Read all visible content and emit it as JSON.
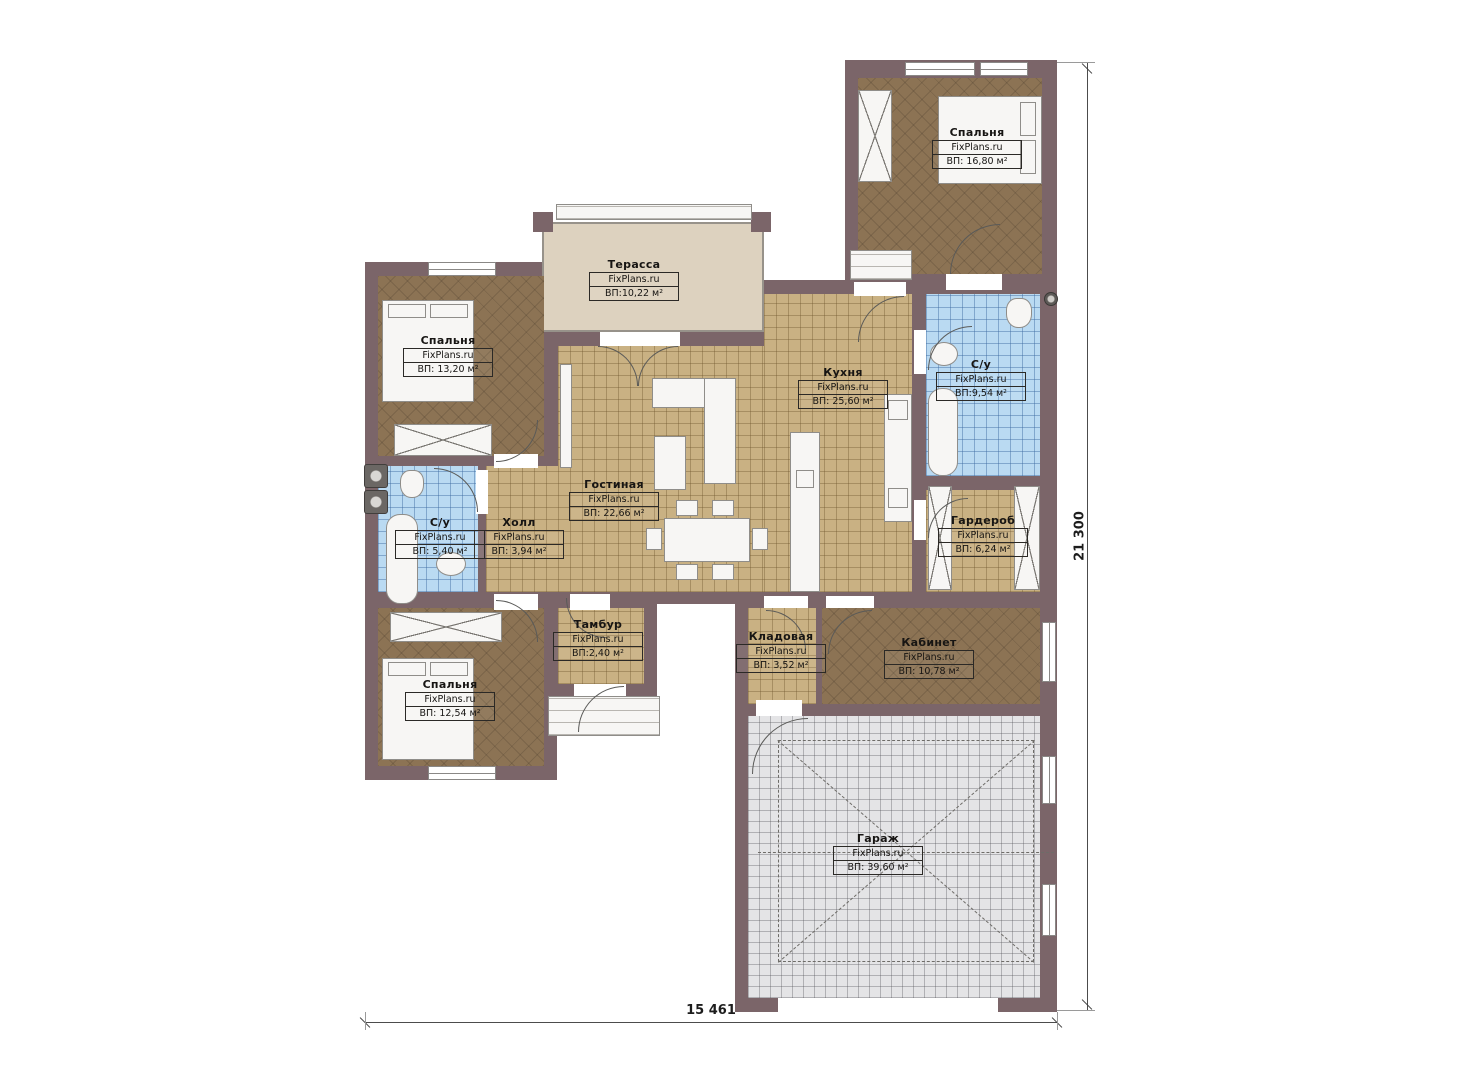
{
  "brand_label": "FixPlans.ru",
  "dimensions": {
    "bottom": "15 461",
    "right": "21 300"
  },
  "colors": {
    "wall": "#7b6569",
    "wood_floor": "#8c7354",
    "tile_floor": "#c9b183",
    "bath_floor": "#badaf2",
    "garage_floor": "#e4e4e6",
    "terrace_floor": "#ddd2bf",
    "furniture": "#f7f6f4"
  },
  "rooms": [
    {
      "id": "bedroom-top-right",
      "name": "Спальня",
      "area": "ВП: 16,80 м²",
      "floor": "wood",
      "rect": [
        858,
        78,
        184,
        196
      ],
      "label": [
        977,
        126
      ]
    },
    {
      "id": "terrace",
      "name": "Терасса",
      "area": "ВП:10,22 м²",
      "floor": "terrace",
      "rect": [
        542,
        222,
        222,
        110
      ],
      "label": [
        634,
        258
      ]
    },
    {
      "id": "bedroom-left-top",
      "name": "Спальня",
      "area": "ВП: 13,20 м²",
      "floor": "wood",
      "rect": [
        378,
        276,
        166,
        180
      ],
      "label": [
        448,
        334
      ]
    },
    {
      "id": "kitchen",
      "name": "Кухня",
      "area": "ВП: 25,60 м²",
      "floor": "tile",
      "rect": [
        764,
        294,
        148,
        298
      ],
      "label": [
        843,
        366
      ]
    },
    {
      "id": "bathroom-top",
      "name": "С/у",
      "area": "ВП:9,54 м²",
      "floor": "bath",
      "rect": [
        926,
        294,
        114,
        182
      ],
      "label": [
        981,
        358
      ]
    },
    {
      "id": "living-room",
      "name": "Гостиная",
      "area": "ВП: 22,66 м²",
      "floor": "tile",
      "rect": [
        558,
        346,
        206,
        246
      ],
      "label": [
        614,
        478
      ]
    },
    {
      "id": "hall",
      "name": "Холл",
      "area": "ВП: 3,94 м²",
      "floor": "tile",
      "rect": [
        486,
        466,
        72,
        126
      ],
      "label": [
        519,
        516
      ]
    },
    {
      "id": "bathroom-left",
      "name": "С/у",
      "area": "ВП: 5,40 м²",
      "floor": "bath",
      "rect": [
        378,
        466,
        100,
        126
      ],
      "label": [
        440,
        516
      ]
    },
    {
      "id": "wardrobe",
      "name": "Гардероб",
      "area": "ВП: 6,24 м²",
      "floor": "tile",
      "rect": [
        926,
        490,
        114,
        102
      ],
      "label": [
        983,
        514
      ]
    },
    {
      "id": "vestibule",
      "name": "Тамбур",
      "area": "ВП:2,40 м²",
      "floor": "tile",
      "rect": [
        558,
        608,
        86,
        76
      ],
      "label": [
        598,
        618
      ]
    },
    {
      "id": "pantry",
      "name": "Кладовая",
      "area": "ВП: 3,52 м²",
      "floor": "tile",
      "rect": [
        748,
        608,
        68,
        96
      ],
      "label": [
        781,
        630
      ]
    },
    {
      "id": "office",
      "name": "Кабинет",
      "area": "ВП: 10,78 м²",
      "floor": "wood",
      "rect": [
        822,
        608,
        218,
        96
      ],
      "label": [
        929,
        636
      ]
    },
    {
      "id": "bedroom-left-bottom",
      "name": "Спальня",
      "area": "ВП: 12,54 м²",
      "floor": "wood",
      "rect": [
        378,
        608,
        166,
        158
      ],
      "label": [
        450,
        678
      ]
    },
    {
      "id": "garage",
      "name": "Гараж",
      "area": "ВП: 39,60 м²",
      "floor": "garage",
      "rect": [
        748,
        716,
        292,
        282
      ],
      "label": [
        878,
        832
      ]
    }
  ],
  "walls": {
    "blocks": [
      [
        845,
        60,
        212,
        230
      ],
      [
        365,
        262,
        192,
        518
      ],
      [
        545,
        332,
        230,
        272
      ],
      [
        752,
        280,
        305,
        324
      ],
      [
        545,
        596,
        112,
        100
      ],
      [
        735,
        596,
        322,
        416
      ]
    ]
  },
  "openings": [
    {
      "t": "wh",
      "r": [
        905,
        62,
        70,
        14
      ]
    },
    {
      "t": "wh",
      "r": [
        980,
        62,
        48,
        14
      ]
    },
    {
      "t": "wh",
      "r": [
        428,
        262,
        68,
        14
      ]
    },
    {
      "t": "wh",
      "r": [
        428,
        766,
        68,
        14
      ]
    },
    {
      "t": "wv",
      "r": [
        1042,
        622,
        14,
        60
      ]
    },
    {
      "t": "wv",
      "r": [
        1042,
        756,
        14,
        48
      ]
    },
    {
      "t": "wv",
      "r": [
        1042,
        884,
        14,
        52
      ]
    },
    {
      "t": "oh",
      "r": [
        600,
        332,
        80,
        14
      ]
    },
    {
      "t": "oh",
      "r": [
        854,
        282,
        52,
        14
      ]
    },
    {
      "t": "oh",
      "r": [
        946,
        274,
        56,
        16
      ]
    },
    {
      "t": "oh",
      "r": [
        494,
        454,
        44,
        14
      ]
    },
    {
      "t": "ov",
      "r": [
        476,
        470,
        12,
        44
      ]
    },
    {
      "t": "ov",
      "r": [
        914,
        330,
        12,
        44
      ]
    },
    {
      "t": "ov",
      "r": [
        914,
        500,
        12,
        40
      ]
    },
    {
      "t": "oh",
      "r": [
        570,
        594,
        40,
        16
      ]
    },
    {
      "t": "oh",
      "r": [
        494,
        594,
        44,
        16
      ]
    },
    {
      "t": "oh",
      "r": [
        574,
        684,
        52,
        12
      ]
    },
    {
      "t": "oh",
      "r": [
        826,
        596,
        48,
        12
      ]
    },
    {
      "t": "oh",
      "r": [
        764,
        596,
        44,
        12
      ]
    },
    {
      "t": "oh",
      "r": [
        756,
        700,
        46,
        16
      ]
    },
    {
      "t": "oh",
      "r": [
        778,
        998,
        220,
        14
      ]
    }
  ],
  "doors": [
    {
      "r": [
        950,
        224,
        50
      ],
      "c": "tl"
    },
    {
      "r": [
        928,
        326,
        44
      ],
      "c": "tl"
    },
    {
      "r": [
        928,
        498,
        40
      ],
      "c": "tl"
    },
    {
      "r": [
        598,
        346,
        40
      ],
      "c": "tr"
    },
    {
      "r": [
        638,
        346,
        40
      ],
      "c": "tl"
    },
    {
      "r": [
        434,
        468,
        44
      ],
      "c": "tr"
    },
    {
      "r": [
        496,
        420,
        42
      ],
      "c": "br"
    },
    {
      "r": [
        496,
        600,
        42
      ],
      "c": "tr"
    },
    {
      "r": [
        566,
        598,
        40
      ],
      "c": "bl"
    },
    {
      "r": [
        578,
        686,
        46
      ],
      "c": "tl"
    },
    {
      "r": [
        858,
        296,
        46
      ],
      "c": "tl"
    },
    {
      "r": [
        766,
        610,
        40
      ],
      "c": "tr"
    },
    {
      "r": [
        828,
        610,
        44
      ],
      "c": "tl"
    },
    {
      "r": [
        752,
        718,
        56
      ],
      "c": "tl"
    }
  ],
  "furniture": [
    {
      "t": "rect",
      "n": "bed",
      "r": [
        938,
        96,
        104,
        88
      ]
    },
    {
      "t": "rect",
      "n": "bed-pillow",
      "r": [
        1020,
        102,
        16,
        34
      ]
    },
    {
      "t": "rect",
      "n": "bed-pillow",
      "r": [
        1020,
        140,
        16,
        34
      ]
    },
    {
      "t": "xbox",
      "n": "wardrobe-cabinet",
      "r": [
        858,
        90,
        34,
        92
      ]
    },
    {
      "t": "rect",
      "n": "bed",
      "r": [
        382,
        300,
        92,
        102
      ]
    },
    {
      "t": "rect",
      "n": "bed-pillow",
      "r": [
        388,
        304,
        38,
        14
      ]
    },
    {
      "t": "rect",
      "n": "bed-pillow",
      "r": [
        430,
        304,
        38,
        14
      ]
    },
    {
      "t": "xbox",
      "n": "wardrobe-cabinet",
      "r": [
        394,
        424,
        98,
        32
      ]
    },
    {
      "t": "rect",
      "n": "bed",
      "r": [
        382,
        658,
        92,
        102
      ]
    },
    {
      "t": "rect",
      "n": "bed-pillow",
      "r": [
        388,
        662,
        38,
        14
      ]
    },
    {
      "t": "rect",
      "n": "bed-pillow",
      "r": [
        430,
        662,
        38,
        14
      ]
    },
    {
      "t": "xbox",
      "n": "wardrobe-cabinet",
      "r": [
        390,
        612,
        112,
        30
      ]
    },
    {
      "t": "rect",
      "n": "sofa",
      "r": [
        652,
        378,
        84,
        30
      ]
    },
    {
      "t": "rect",
      "n": "sofa",
      "r": [
        704,
        378,
        32,
        106
      ]
    },
    {
      "t": "rect",
      "n": "coffee-table",
      "r": [
        654,
        436,
        32,
        54
      ]
    },
    {
      "t": "rect",
      "n": "tv-console",
      "r": [
        560,
        364,
        12,
        104
      ]
    },
    {
      "t": "rect",
      "n": "dining-table",
      "r": [
        664,
        518,
        86,
        44
      ]
    },
    {
      "t": "rect",
      "n": "chair",
      "r": [
        676,
        500,
        22,
        16
      ]
    },
    {
      "t": "rect",
      "n": "chair",
      "r": [
        712,
        500,
        22,
        16
      ]
    },
    {
      "t": "rect",
      "n": "chair",
      "r": [
        676,
        564,
        22,
        16
      ]
    },
    {
      "t": "rect",
      "n": "chair",
      "r": [
        712,
        564,
        22,
        16
      ]
    },
    {
      "t": "rect",
      "n": "chair",
      "r": [
        646,
        528,
        16,
        22
      ]
    },
    {
      "t": "rect",
      "n": "chair",
      "r": [
        752,
        528,
        16,
        22
      ]
    },
    {
      "t": "rect",
      "n": "kitchen-island",
      "r": [
        790,
        432,
        30,
        160
      ]
    },
    {
      "t": "rect",
      "n": "kitchen-sink",
      "r": [
        796,
        470,
        18,
        18
      ]
    },
    {
      "t": "rect",
      "n": "kitchen-counter",
      "r": [
        884,
        394,
        28,
        128
      ]
    },
    {
      "t": "rect",
      "n": "stove",
      "r": [
        888,
        400,
        20,
        20
      ]
    },
    {
      "t": "rect",
      "n": "appliance",
      "r": [
        888,
        488,
        20,
        20
      ]
    },
    {
      "t": "tub",
      "n": "bathtub",
      "r": [
        928,
        388,
        30,
        88
      ]
    },
    {
      "t": "toilet",
      "n": "toilet",
      "r": [
        1006,
        298,
        26,
        30
      ]
    },
    {
      "t": "round",
      "n": "washbasin",
      "r": [
        930,
        342,
        28,
        24
      ]
    },
    {
      "t": "tub",
      "n": "bathtub",
      "r": [
        386,
        514,
        32,
        90
      ]
    },
    {
      "t": "toilet",
      "n": "toilet",
      "r": [
        400,
        470,
        24,
        28
      ]
    },
    {
      "t": "round",
      "n": "washbasin",
      "r": [
        436,
        552,
        30,
        24
      ]
    },
    {
      "t": "machine",
      "n": "washer",
      "r": [
        364,
        464,
        24,
        24
      ]
    },
    {
      "t": "machine",
      "n": "washer",
      "r": [
        364,
        490,
        24,
        24
      ]
    },
    {
      "t": "vent",
      "n": "vent-fan",
      "r": [
        1044,
        292,
        14,
        14
      ]
    },
    {
      "t": "xbox",
      "n": "wardrobe-cabinet",
      "r": [
        928,
        486,
        24,
        104
      ]
    },
    {
      "t": "xbox",
      "n": "wardrobe-cabinet",
      "r": [
        1014,
        486,
        26,
        104
      ]
    },
    {
      "t": "steps",
      "n": "porch-steps",
      "r": [
        548,
        696,
        112,
        40
      ]
    },
    {
      "t": "steps",
      "n": "porch-steps",
      "r": [
        850,
        250,
        62,
        30
      ]
    },
    {
      "t": "steps",
      "n": "terrace-step",
      "r": [
        556,
        204,
        196,
        16
      ]
    },
    {
      "t": "pillar",
      "n": "terrace-pillar",
      "r": [
        533,
        212,
        20,
        20
      ]
    },
    {
      "t": "pillar",
      "n": "terrace-pillar",
      "r": [
        751,
        212,
        20,
        20
      ]
    },
    {
      "t": "dash-rect",
      "n": "parking-zone",
      "r": [
        778,
        740,
        256,
        222
      ]
    },
    {
      "t": "dash-line",
      "n": "parking-diagonal",
      "r": [
        778,
        740,
        339,
        0
      ],
      "rot": 40.9
    },
    {
      "t": "dash-line",
      "n": "parking-diagonal",
      "r": [
        778,
        962,
        339,
        0
      ],
      "rot": -40.9
    },
    {
      "t": "dash-line",
      "n": "axis-line",
      "r": [
        758,
        852,
        296,
        0
      ],
      "rot": 0
    }
  ]
}
